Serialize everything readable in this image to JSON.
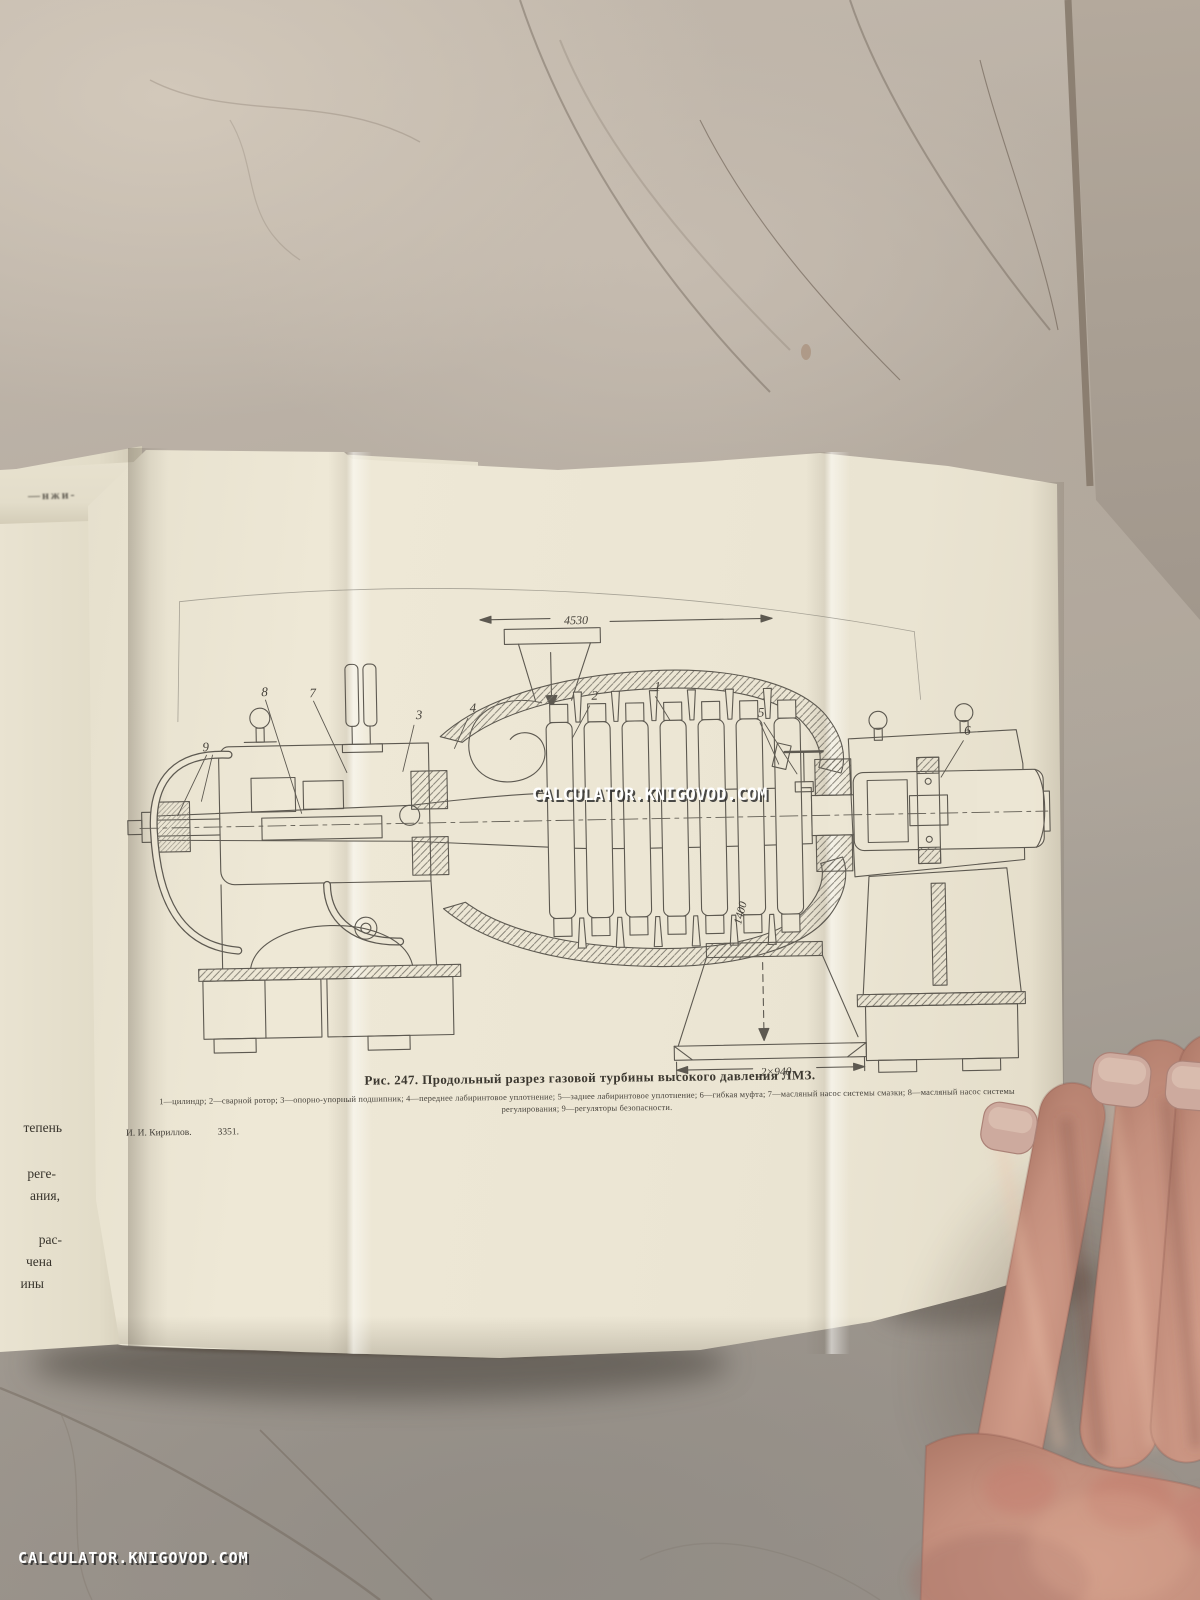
{
  "watermark": {
    "text": "CALCULATOR.KNIGOVOD.COM"
  },
  "book": {
    "left_page": {
      "fragments": [
        "тепень",
        "реге-",
        "ания,",
        "рас-",
        "чена",
        "ины"
      ],
      "top_fragment": "—нжи-"
    },
    "figure": {
      "caption": "Рис. 247. Продольный разрез газовой турбины высокого давления ЛМЗ.",
      "legend_line1": "1—цилиндр; 2—сварной ротор; 3—опорно-упорный подшипник; 4—переднее лабиринтовое уплотнение; 5—заднее лабиринтовое уплотнение; 6—гибкая муфта; 7—масляный насос системы смазки; 8—масляный насос системы",
      "legend_line2": "регулирования; 9—регуляторы безопасности.",
      "printer_name": "И. И. Кириллов.",
      "printer_number": "3351.",
      "dimensions": {
        "length": "4530",
        "height": "1400",
        "outlet": "2×940"
      },
      "part_labels": [
        "1",
        "2",
        "3",
        "4",
        "5",
        "6",
        "7",
        "8",
        "9"
      ]
    }
  },
  "colors": {
    "page": "#ece6d4",
    "ink": "#56524a",
    "floor": "#b4aba0",
    "skin": "#c48f7d"
  }
}
